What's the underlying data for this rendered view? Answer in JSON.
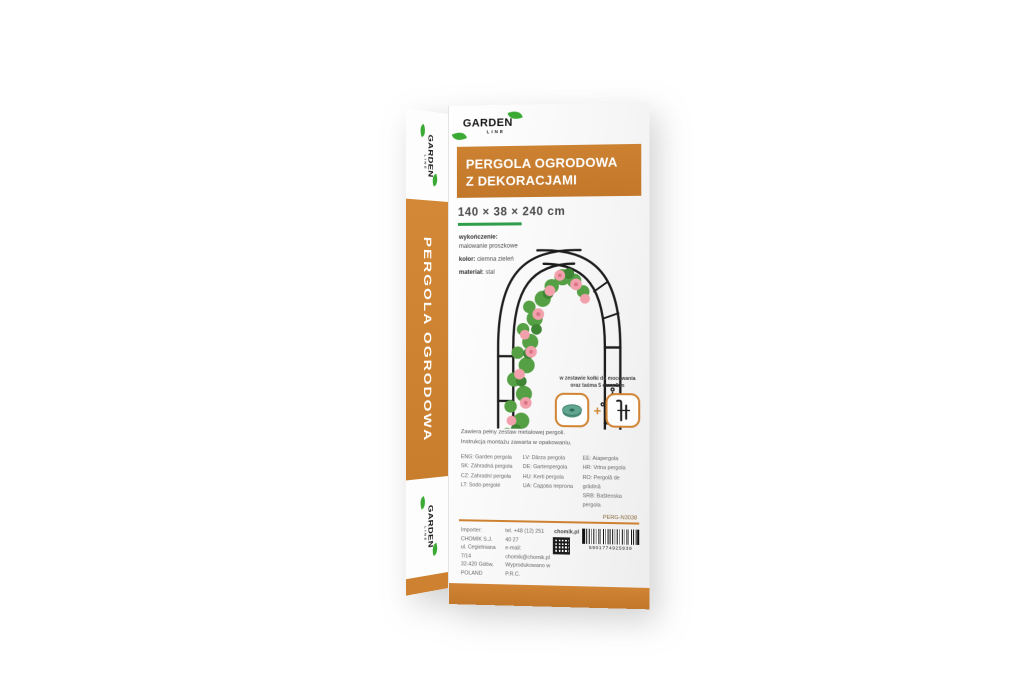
{
  "brand": {
    "name_top": "GARDEN",
    "name_bottom": "LINE"
  },
  "side_panel": {
    "vertical_title": "PERGOLA OGRODOWA"
  },
  "front": {
    "title_line1": "PERGOLA OGRODOWA",
    "title_line2": "Z DEKORACJAMI",
    "dimensions": "140 × 38 × 240 cm",
    "specs": [
      {
        "label": "wykończenie:",
        "value": "malowanie proszkowe"
      },
      {
        "label": "kolor:",
        "value": "ciemna zieleń"
      },
      {
        "label": "materiał:",
        "value": "stal"
      }
    ],
    "included_note_line1": "w zestawie kołki do mocowania",
    "included_note_line2": "oraz taśma 5 cm × 5 m",
    "plus_sign": "+",
    "notes": [
      "Zawiera pełny zestaw metalowej pergoli.",
      "Instrukcja montażu zawarta w opakowaniu."
    ],
    "translations": {
      "col1": [
        "ENG: Garden pergola",
        "SK: Záhradná pergola",
        "CZ: Zahradní pergola",
        "LT: Sodo pergolė"
      ],
      "col2": [
        "LV: Dārza pergola",
        "DE: Gartenpergola",
        "HU: Kerti pergola",
        "UA: Садова пергола"
      ],
      "col3": [
        "EE: Aiapergola",
        "HR: Vrtna pergola",
        "RO: Pergolă de grădină",
        "SRB: Baštenska pergola"
      ]
    },
    "product_code": "PERG-N3038",
    "importer": [
      "Importer: CHOMIK S.J.",
      "ul. Cegielniana 7/14",
      "32-420 Gdów, POLAND"
    ],
    "contact": [
      "tel. +48 (12) 251 40 27",
      "e-mail: chomik@chomik.pl",
      "Wyprodukowano w P.R.C."
    ],
    "website": "chomik.pl",
    "barcode_number": "5901774925939"
  },
  "colors": {
    "orange": "#CE8231",
    "green_accent": "#2E9E4B",
    "leaf_green": "#3BAA35",
    "rose_pink": "#F2A0AC",
    "foliage_green": "#55A044",
    "tape_teal": "#5FA58F"
  }
}
